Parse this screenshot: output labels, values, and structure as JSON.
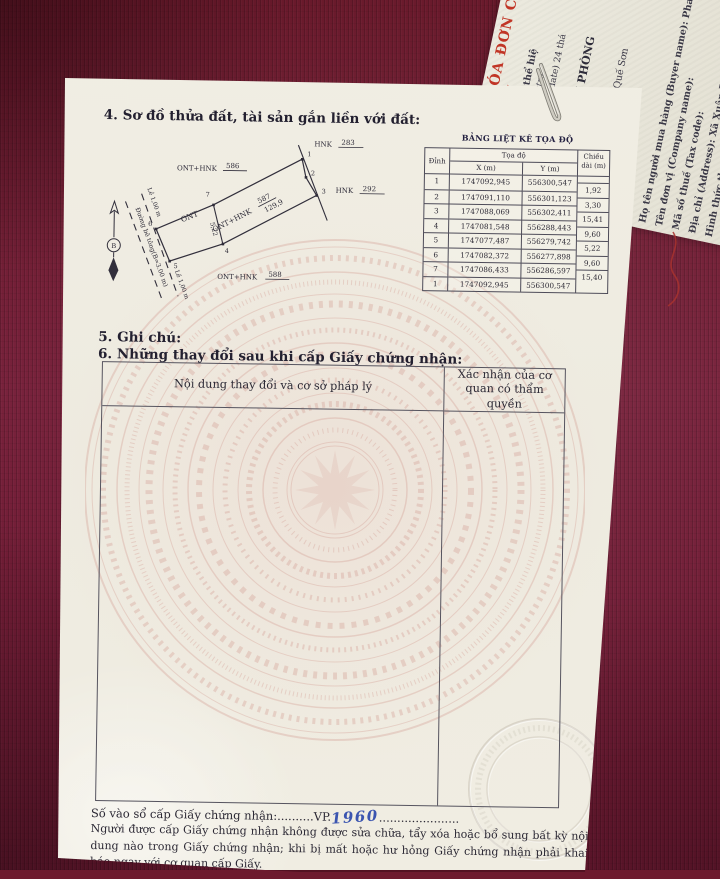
{
  "page": {
    "section4_title": "4. Sơ đồ thửa đất, tài sản gắn liền với đất:",
    "section5_title": "5. Ghi chú:",
    "section6_title": "6. Những thay đổi sau khi cấp Giấy chứng nhận:",
    "changes_table": {
      "col1_header": "Nội dung thay đổi và cơ sở pháp lý",
      "col2_header": "Xác nhận của cơ quan có thẩm quyền"
    },
    "book_entry": {
      "label": "Số vào sổ cấp Giấy chứng nhận:",
      "dots1": "..........",
      "prefix": "VP.",
      "handwritten_number": "1960",
      "dots2": "......................"
    },
    "footer_note": "Người được cấp Giấy chứng nhận không được sửa chữa, tẩy xóa hoặc bổ sung bất kỳ nội dung nào trong Giấy chứng nhận; khi bị mất hoặc hư hỏng Giấy chứng nhận phải khai báo ngay với cơ quan cấp Giấy."
  },
  "diagram": {
    "adjacent_parcels": [
      {
        "use": "HNK",
        "num": "283"
      },
      {
        "use": "ONT+HNK",
        "num": "586"
      },
      {
        "use": "HNK",
        "num": "292"
      },
      {
        "use": "ONT+HNK",
        "num": "588"
      }
    ],
    "parcel": {
      "use": "ONT+HNK",
      "number": "587",
      "area": "129,9"
    },
    "left_parcel_use": "ONT",
    "divider_length": "5,22",
    "road_label": "Đường bê tông(B=3.00 m)",
    "margin_label_1": "Lề 1,00 m",
    "margin_label_2": "Lề 1,00 m",
    "north_label": "B",
    "vertices": [
      "1",
      "2",
      "3",
      "4",
      "5",
      "6",
      "7"
    ]
  },
  "coord_table": {
    "title": "BẢNG LIỆT KÊ TỌA ĐỘ",
    "col_vertex": "Đỉnh",
    "col_coords": "Tọa độ",
    "col_x": "X (m)",
    "col_y": "Y (m)",
    "col_length": "Chiều dài (m)",
    "rows": [
      {
        "v": "1",
        "x": "1747092,945",
        "y": "556300,547"
      },
      {
        "v": "2",
        "x": "1747091,110",
        "y": "556301,123"
      },
      {
        "v": "3",
        "x": "1747088,069",
        "y": "556302,411"
      },
      {
        "v": "4",
        "x": "1747081,548",
        "y": "556288,443"
      },
      {
        "v": "5",
        "x": "1747077,487",
        "y": "556279,742"
      },
      {
        "v": "6",
        "x": "1747082,372",
        "y": "556277,898"
      },
      {
        "v": "7",
        "x": "1747086,433",
        "y": "556286,597"
      },
      {
        "v": "1",
        "x": "1747092,945",
        "y": "556300,547"
      }
    ],
    "lengths": [
      "1,92",
      "3,30",
      "15,41",
      "9,60",
      "5,22",
      "9,60",
      "15,40"
    ]
  },
  "invoice": {
    "lines": [
      {
        "text": "HÓA ĐƠN C"
      },
      {
        "text": "(1/"
      },
      {
        "text": "Bản thể hiệ"
      },
      {
        "text": "(Electro"
      },
      {
        "text": "Ngày (date) 24 thá"
      },
      {
        "text": "ANH VĂN PHÒNG"
      },
      {
        "text": "2-002"
      },
      {
        "text": "Thăng, Xã Quế Sơn"
      },
      {
        "text": "50709"
      },
      {
        "text": "Họ tên người mua hàng (Buyer name): Phan Thị Hải"
      },
      {
        "text": "Tên đơn vị (Company name):"
      },
      {
        "text": "Mã số thuế (Tax code):"
      },
      {
        "text": "Địa chỉ (Address): Xã Xuân Phú, thành phố Đà Nẵng"
      },
      {
        "text": "Hình thức thanh toán (Payment method): TM/CK"
      }
    ]
  },
  "colors": {
    "fabric": "#6d1a2e",
    "paper": "#f0ede2",
    "ink": "#2b2834",
    "invoice_red": "#c13526",
    "handwriting_blue": "#3b55b0",
    "watermark_pink": "#cf9288"
  }
}
